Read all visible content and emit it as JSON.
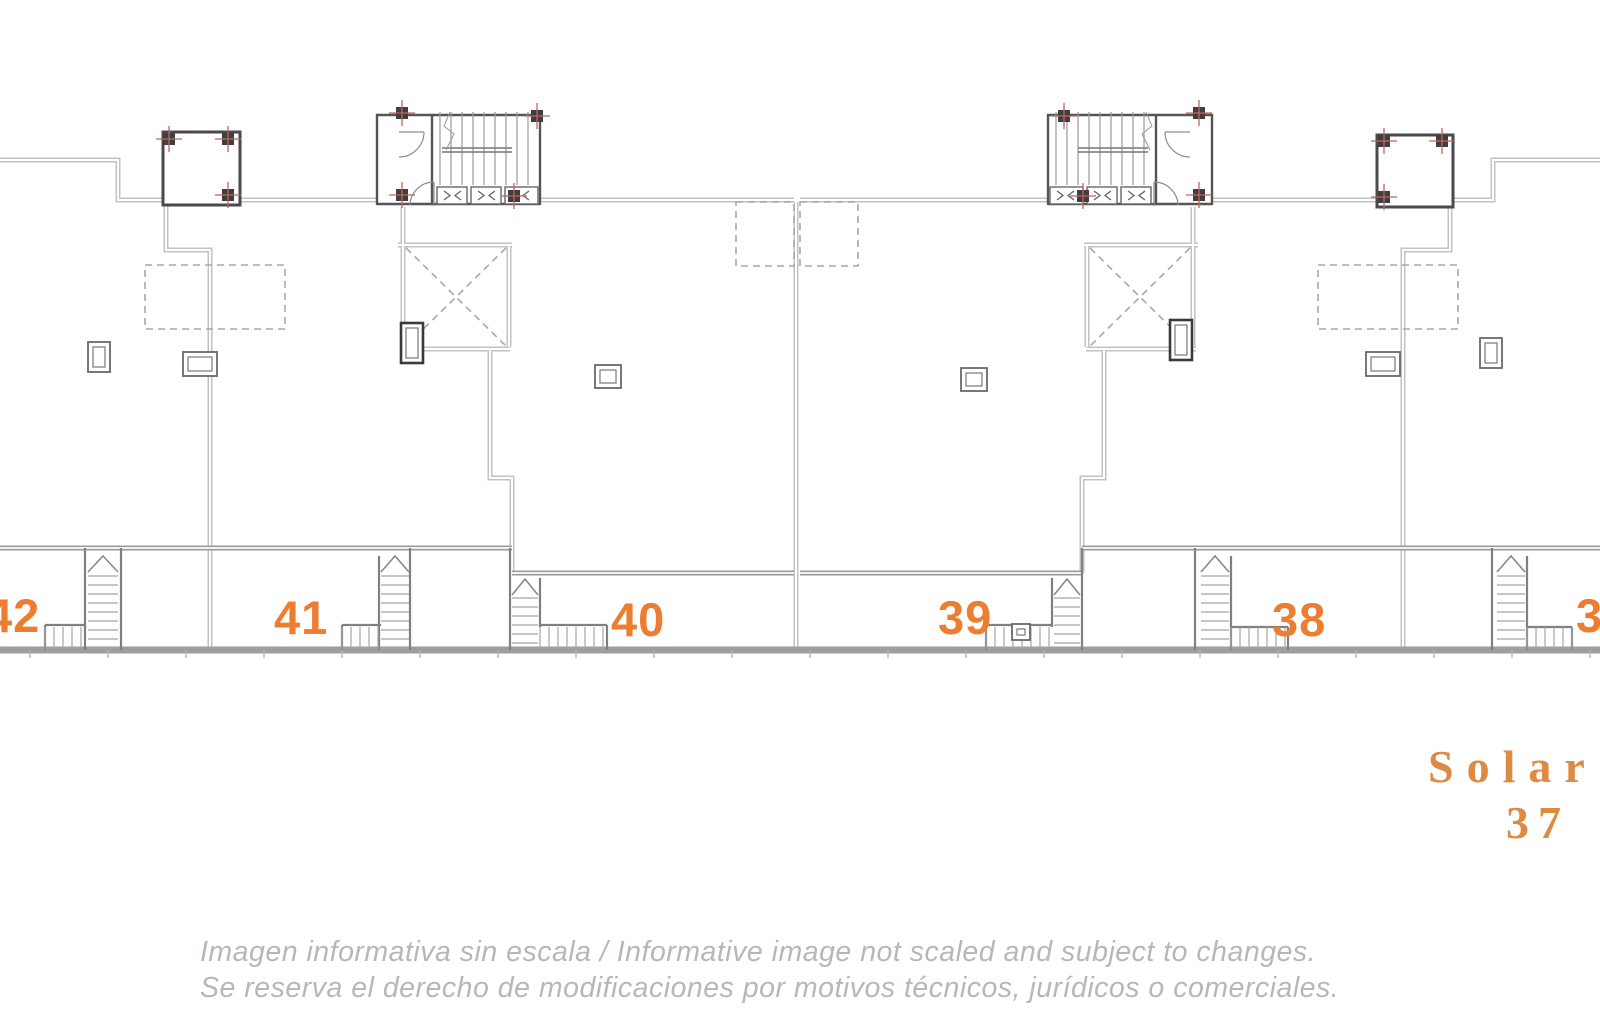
{
  "plan": {
    "unit_labels": [
      "42",
      "41",
      "40",
      "39",
      "38",
      "37"
    ]
  },
  "legend": {
    "line1": "Solar",
    "line2": "37"
  },
  "disclaimer": {
    "line1": "Imagen informativa sin escala /  Informative image not scaled and subject to changes.",
    "line2": "Se reserva el derecho de modificaciones por motivos técnicos, jurídicos o comerciales."
  },
  "colors": {
    "accent_orange": "#ED7D31",
    "legend_orange": "#DD8A42",
    "disclaimer_gray": "#B5B8BA",
    "wall_light_gray": "#C2C2C2",
    "wall_mid_gray": "#9A9A9A",
    "wall_dark": "#555555",
    "marker_red": "#C4655A"
  }
}
